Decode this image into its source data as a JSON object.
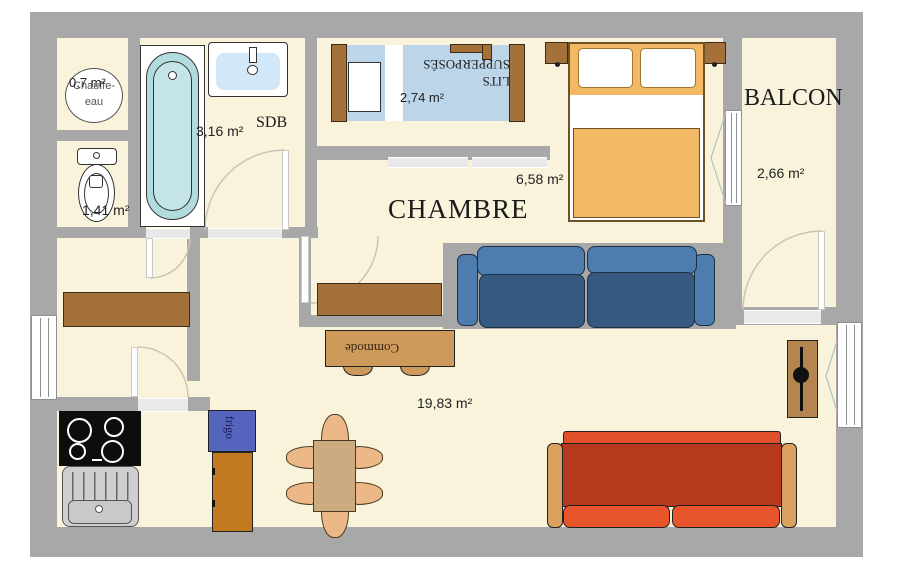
{
  "plan": {
    "rooms": {
      "chauffe_eau": {
        "label_line1": "Chauffe-",
        "label_line2": "eau",
        "area": "0,7 m²"
      },
      "wc": {
        "area": "1,41 m²"
      },
      "sdb": {
        "name": "SDB",
        "area": "3,16 m²"
      },
      "bunk_alcove": {
        "area": "2,74 m²"
      },
      "chambre": {
        "name": "CHAMBRE",
        "area": "6,58 m²"
      },
      "balcon": {
        "name": "BALCON",
        "area": "2,66 m²"
      },
      "living": {
        "area": "19,83 m²"
      }
    },
    "furniture_labels": {
      "bunk_beds": "LITS SUPPERPOSÉS",
      "commode": "Commode",
      "fridge": "frigo"
    },
    "colors": {
      "floor": "#faf3dc",
      "wall": "#a8a8a8",
      "bathtub": "#b2dbdf",
      "bathtub_inner": "#c4e4e7",
      "sink_basin": "#d2e7f7",
      "bunk_mattress": "#bdd5e9",
      "bed_blanket": "#f2b863",
      "sofa_blue_back": "#4d7dae",
      "sofa_blue_seat": "#35597f",
      "sofa_red_body": "#b83a1e",
      "sofa_red_seat": "#e8552b",
      "sofa_red_armrest": "#d9a05f",
      "wood_dark": "#a5713a",
      "commode_wood": "#cd9a5c",
      "table_wood": "#cdab80",
      "chair_wood": "#ecb887",
      "fridge_top": "#5565bd",
      "fridge_body": "#c17a1f",
      "door_arc": "#ccc4b2"
    }
  }
}
